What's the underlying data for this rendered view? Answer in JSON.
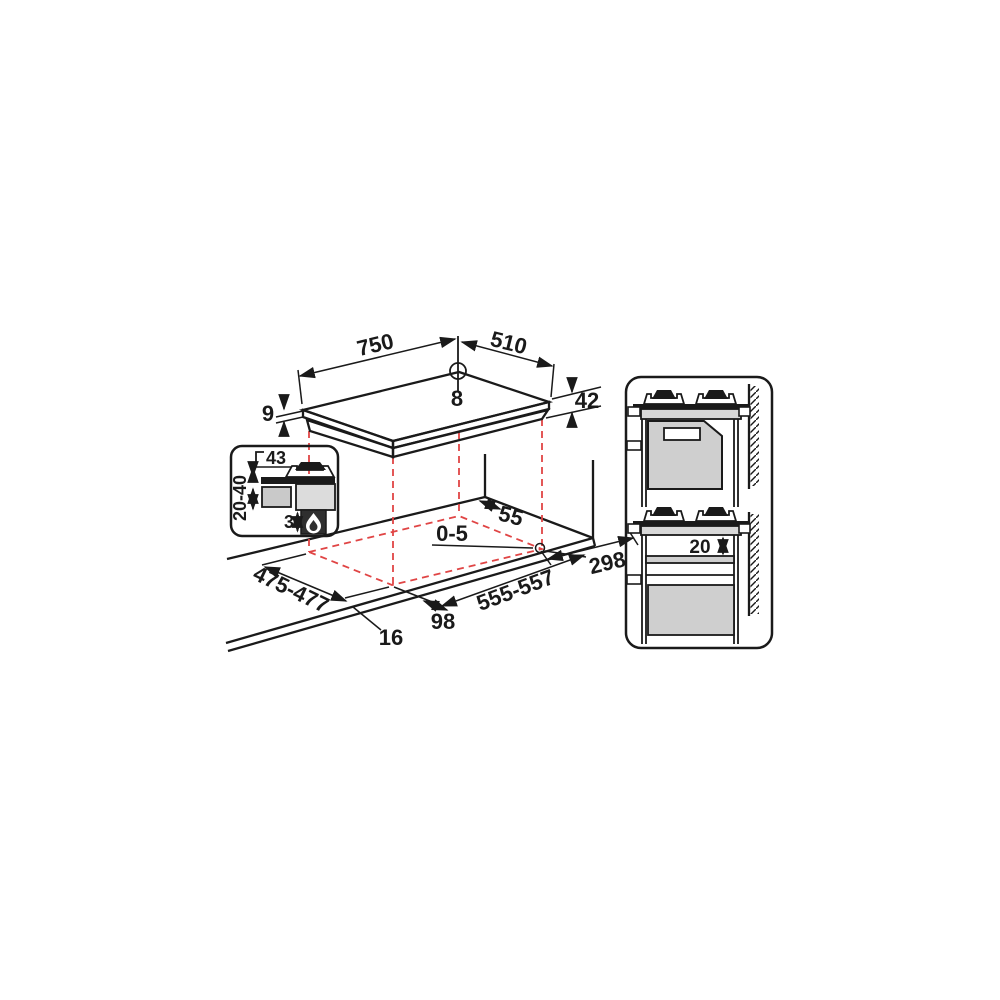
{
  "colors": {
    "line": "#1a1a1a",
    "projection_red": "#e04545",
    "fill_light_gray": "#d8d8d8",
    "fill_mid_gray": "#c9c9c9",
    "fill_panel_gray": "#cfcfcf",
    "fill_dark": "#2f2f2f",
    "background": "#ffffff"
  },
  "hob_view": {
    "dim_width_mm": "750",
    "dim_depth_mm": "510",
    "dim_hole_diameter_mm": "8",
    "dim_glass_thickness_mm": "9",
    "dim_body_height_mm": "42"
  },
  "cutout_view": {
    "dim_rear_clearance_mm": "55",
    "dim_hole_position_mm": "0-5",
    "dim_right_clearance_mm": "298",
    "dim_cutout_depth_mm": "475-477",
    "dim_cutout_width_mm": "555-557",
    "dim_front_clearance_mm": "98",
    "dim_front_edge_mm": "16"
  },
  "section_detail": {
    "dim_overhang_mm": "43",
    "dim_clearance_range_mm": "20-40",
    "dim_burner_box_gap_mm": "3",
    "icon": "gas-flame-icon"
  },
  "side_views": {
    "dim_shelf_clearance_mm": "20"
  }
}
